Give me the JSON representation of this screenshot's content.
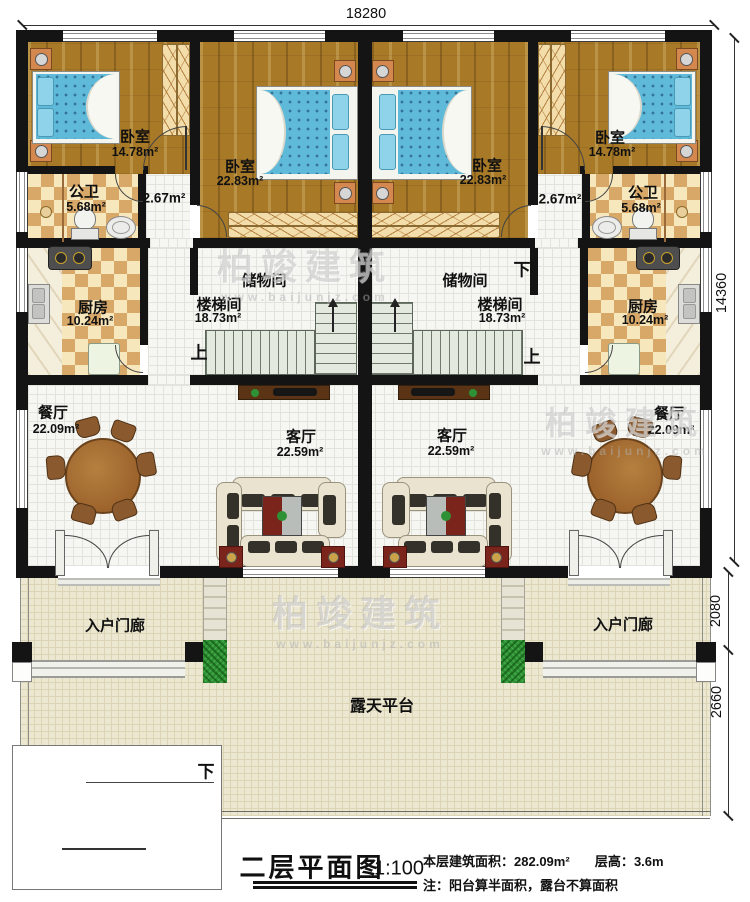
{
  "dimensions": {
    "top_width": "18280",
    "right_main": "14360",
    "right_porch": "2080",
    "right_terrace": "2660"
  },
  "labels": {
    "bedroom_small": "卧室",
    "bedroom_small_area": "14.78m²",
    "bedroom_big": "卧室",
    "bedroom_big_area": "22.83m²",
    "bath": "公卫",
    "bath_area": "5.68m²",
    "hall_area": "2.67m²",
    "kitchen": "厨房",
    "kitchen_area": "10.24m²",
    "storage": "储物间",
    "stairroom": "楼梯间",
    "stairroom_area": "18.73m²",
    "dining": "餐厅",
    "dining_area": "22.09m²",
    "living": "客厅",
    "living_area": "22.59m²",
    "porch": "入户门廊",
    "terrace": "露天平台",
    "up": "上",
    "down": "下"
  },
  "title_block": {
    "title": "二层平面图",
    "scale": "1:100",
    "build_area_label": "本层建筑面积：",
    "build_area_value": "282.09m²",
    "floor_height_label": "层高：",
    "floor_height_value": "3.6m",
    "note": "注：阳台算半面积，露台不算面积"
  },
  "watermark": {
    "name": "柏竣建筑",
    "url": "www.baijunjz.com"
  },
  "colors": {
    "wall": "#141414",
    "wood": "#a87a28",
    "checkerDark": "#d8a868",
    "checkerLight": "#f6e7bd",
    "mattress": "#5fb9d9",
    "pillow": "#8fd3ea",
    "stairTread": "#e3e9df",
    "terrace": "#ece7d1",
    "tile": "#f6f6f3",
    "tableWood": "#9c632c",
    "coffeeTable": "#7a241c",
    "grass": "#2f9135",
    "marble": "#f4eedd",
    "nightstand": "#d4874e"
  }
}
